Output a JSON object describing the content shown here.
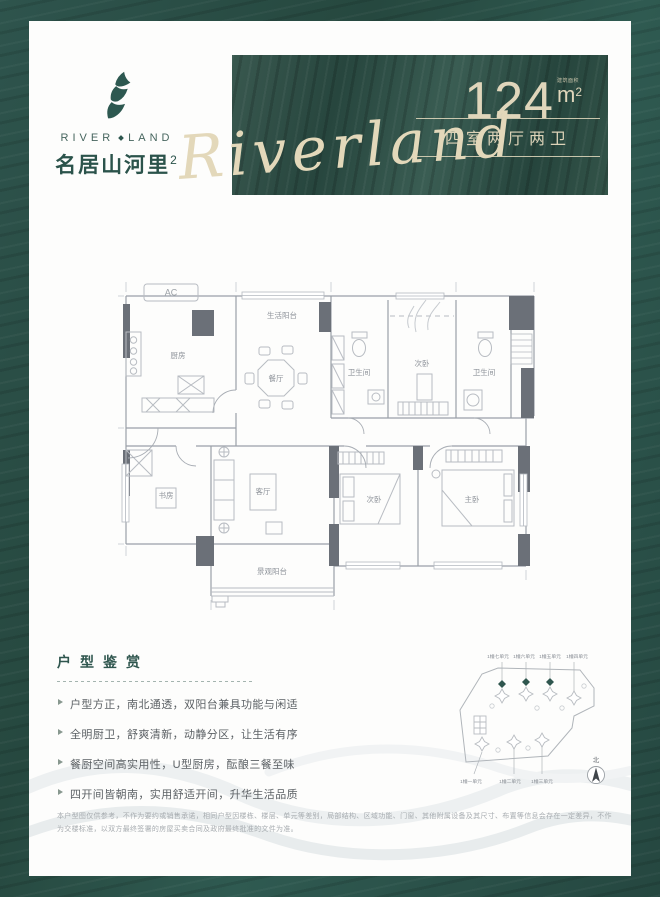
{
  "logo": {
    "en_left": "RIVER",
    "en_right": "LAND",
    "cn": "名居山河里",
    "sup": "2"
  },
  "banner": {
    "area_value": "124",
    "area_label": "建筑面积",
    "area_unit": "m",
    "area_sup": "2",
    "spec": "四室两厅两卫",
    "script": "Riverland"
  },
  "floorplan": {
    "ac": "AC",
    "service_balcony": "生活阳台",
    "kitchen": "厨房",
    "dining": "餐厅",
    "bath_a": "卫生间",
    "bedroom_top": "次卧",
    "bath_b": "卫生间",
    "study": "书房",
    "living": "客厅",
    "bedroom_bottom": "次卧",
    "master": "主卧",
    "view_balcony": "景观阳台"
  },
  "features": {
    "title": "户型鉴赏",
    "items": [
      "户型方正，南北通透，双阳台兼具功能与闲适",
      "全明厨卫，舒爽清新，动静分区，让生活有序",
      "餐厨空间高实用性，U型厨房，酝酿三餐至味",
      "四开间皆朝南，实用舒适开间，升华生活品质"
    ]
  },
  "siteplan": {
    "top_labels": [
      "1幢七单元",
      "1幢六单元",
      "1幢五单元",
      "1幢四单元"
    ],
    "bottom_labels": [
      "1幢一单元",
      "1幢二单元",
      "1幢三单元"
    ],
    "compass": "北"
  },
  "disclaimer": "本户型图仅供参考，不作为要约或销售承诺，相同户型因楼栋、楼层、单元等差别，局部结构、区域功能、门窗、其他附属设备及其尺寸、布置等信息会存在一定差异，不作为交楼标准，以双方最终签署的房屋买卖合同及政府最终批准的文件为准。",
  "colors": {
    "frame_green": "#2b4f49",
    "banner_green": "#31544c",
    "cream": "#ddd3b8",
    "logo_green": "#2c544c"
  }
}
